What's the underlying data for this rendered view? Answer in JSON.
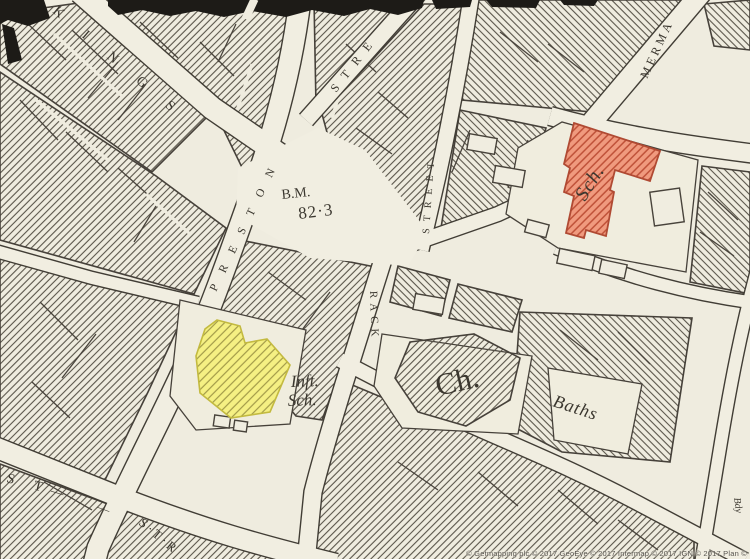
{
  "map": {
    "background": "#efecdf",
    "ink": "#46413a",
    "streets": {
      "king": "KINGS",
      "preston": "PRESTON",
      "fork": "STRE",
      "north": "STREET",
      "rack": "RACK",
      "mermaid": "MERMA",
      "bottom_a": "ST",
      "bottom_dash1": "—",
      "bottom_dash2": "—",
      "bottom_b": "S·T·R"
    },
    "labels": {
      "bench_mark": "B.M.",
      "bench_value": "82·3",
      "infant_school_1": "Inft.",
      "infant_school_2": "Sch.",
      "church": "Ch.",
      "baths": "Baths",
      "school": "Sch.",
      "boundary": "Bdy"
    },
    "features": {
      "school": {
        "fill": "#f09a7e",
        "hatch": "#bf5138",
        "outline": "#b04a33",
        "text": "#7c2a1c"
      },
      "infant_school": {
        "fill": "#f5f083",
        "hatch": "#a29a48",
        "outline": "#c3ba40"
      }
    },
    "attribution": "© Getmapping plc © 2017 GeoEye © 2017 Intermap © 2017 IGN © 2017 Plan ©"
  }
}
